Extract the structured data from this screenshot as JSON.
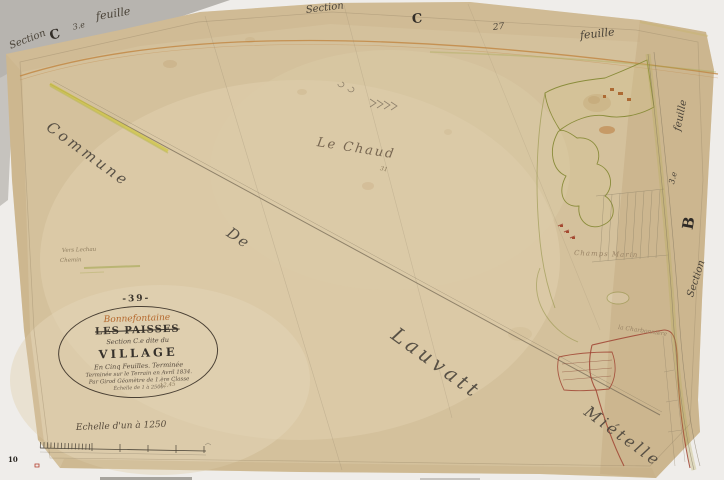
{
  "colors": {
    "paper": "#d4c19c",
    "paper_light": "#e0d0af",
    "paper_dark": "#c2a87e",
    "ink": "#4a4338",
    "pencil": "#8a7c64",
    "orange_road": "#c08440",
    "yellow_road": "#cfc544",
    "olive_parcel": "#8a8c3a",
    "red_boundary": "#a04433",
    "cartouche_orange": "#b5672b",
    "backdrop_gray": "#b7b4af"
  },
  "edge_labels": {
    "top_left": {
      "section": "Section",
      "letter": "C",
      "sheet_no": "3.e",
      "feuille": "feuille"
    },
    "top_center": {
      "section": "Section",
      "letter": "C",
      "number": "27",
      "feuille": "feuille"
    },
    "right_edge": {
      "feuille": "feuille",
      "sheet_no": "3.e",
      "letter": "B",
      "section": "Section"
    }
  },
  "display_words": {
    "commune": "Commune",
    "de": "De",
    "lauvatt": "Lauvatt",
    "mietelle": "Miételle"
  },
  "place_labels": {
    "le_chaud": "Le Chaud",
    "le_chaud_number": "31",
    "champs_marin": "Champs Marin",
    "la_charbonniere": "la Charbonnière",
    "margin_note_line1": "Vers Lechau",
    "margin_note_line2": "Chemin"
  },
  "cartouche": {
    "plate_number": "-39-",
    "commune_name": "Bonnefontaine",
    "title_struck": "LES PAISSES",
    "section_line": "Section C.e dite du",
    "section_name": "VILLAGE",
    "detail_line1": "En Cinq Feuilles. Terminée",
    "detail_line2": "Terminée sur le Terrain en Avril 1834.",
    "detail_line3": "Par Girod Géomètre de 1.ère Classe",
    "detail_line4": "Échelle de 1 à 2500.",
    "pencil_note": "12,45"
  },
  "scale_bar": {
    "label": "Echelle d'un à 1250"
  },
  "corner_marks": {
    "page_stamp": "10"
  }
}
